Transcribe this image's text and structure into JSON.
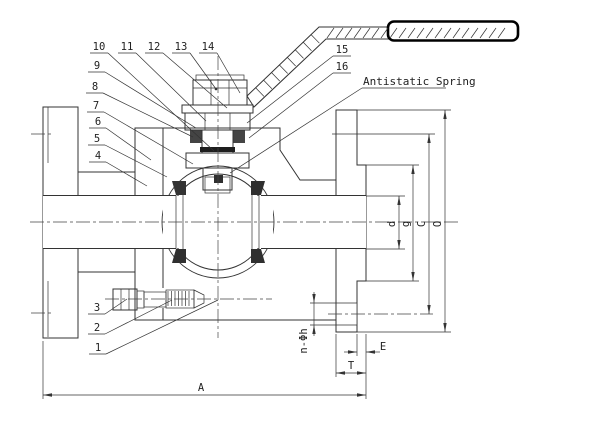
{
  "drawing": {
    "annotations": {
      "antistatic_spring": "Antistatic Spring"
    },
    "callouts": [
      {
        "label": "1"
      },
      {
        "label": "2"
      },
      {
        "label": "3"
      },
      {
        "label": "4"
      },
      {
        "label": "5"
      },
      {
        "label": "6"
      },
      {
        "label": "7"
      },
      {
        "label": "8"
      },
      {
        "label": "9"
      },
      {
        "label": "10"
      },
      {
        "label": "11"
      },
      {
        "label": "12"
      },
      {
        "label": "13"
      },
      {
        "label": "14"
      },
      {
        "label": "15"
      },
      {
        "label": "16"
      }
    ],
    "dimensions": {
      "overall_length": "A",
      "flange_thickness": "T",
      "raised_face_height": "E",
      "bolt_holes": "n-Φh",
      "bore_diameter": "d",
      "gasket_face_diameter": "g",
      "bolt_circle_diameter": "C",
      "flange_outer_diameter": "O"
    },
    "colors": {
      "line": "#333333",
      "dark_fill": "#2f2f2f",
      "background": "#ffffff"
    }
  }
}
